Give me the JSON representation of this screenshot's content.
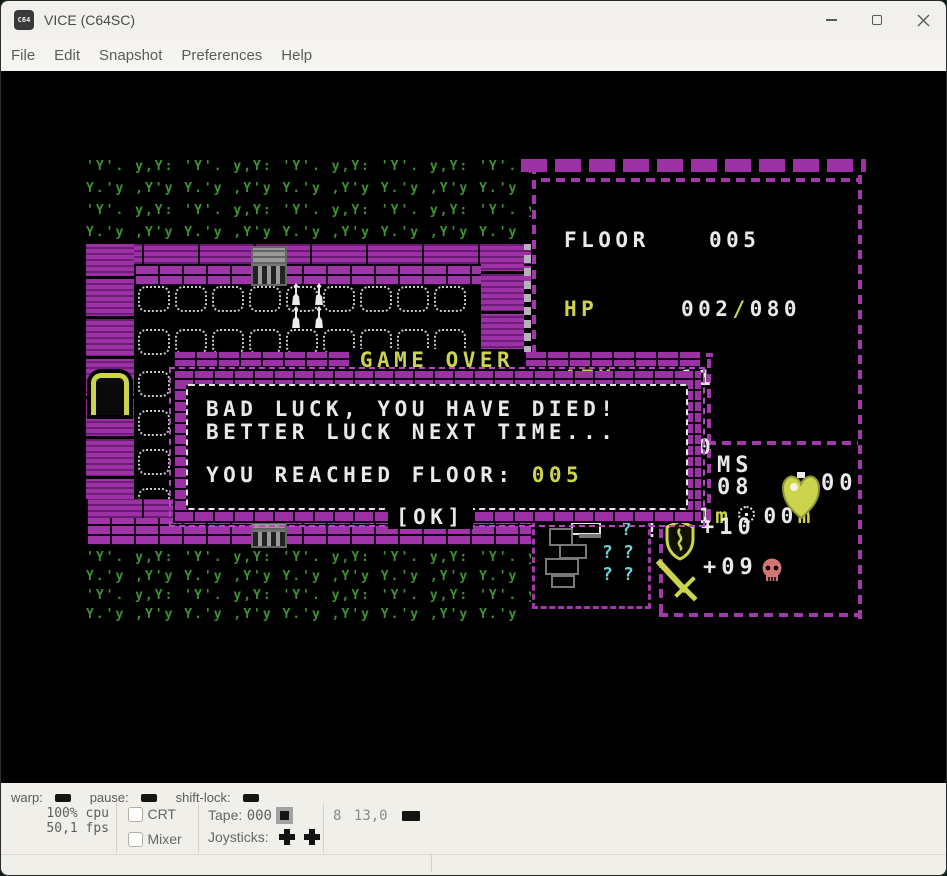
{
  "window": {
    "title": "VICE (C64SC)",
    "icon_text": "C64"
  },
  "menubar": {
    "items": [
      {
        "label": "File"
      },
      {
        "label": "Edit"
      },
      {
        "label": "Snapshot"
      },
      {
        "label": "Preferences"
      },
      {
        "label": "Help"
      }
    ]
  },
  "game": {
    "stats": {
      "floor_label": "FLOOR",
      "floor": "005",
      "hp_label": "HP",
      "hp_current": "002",
      "hp_sep": "/",
      "hp_max": "080",
      "atk_label": "ATK",
      "atk": "11",
      "def_label": "DEF",
      "def": "20",
      "range_label": "RANGE",
      "range_melee": "01",
      "range_melee_unit": "m",
      "range_ranged": "00",
      "range_ranged_unit": "m",
      "gold": "$0137"
    },
    "dialog": {
      "title": "GAME OVER",
      "line1": "BAD LUCK, YOU HAVE DIED!",
      "line2": "BETTER LUCK NEXT TIME...",
      "line3_label": "YOU REACHED FLOOR: ",
      "line3_value": "005",
      "ok_label": "[OK]"
    },
    "hud": {
      "ms_label": "MS",
      "ms_value": "08",
      "potion_count": "00",
      "shield_bonus": "+10",
      "sword_bonus": "+09"
    },
    "minimap": {
      "question_mark": "?",
      "alert_mark": "!"
    }
  },
  "statusbar": {
    "warp_label": "warp:",
    "pause_label": "pause:",
    "shiftlock_label": "shift-lock:",
    "cpu": "100% cpu",
    "fps": "50,1 fps",
    "crt_label": "CRT",
    "mixer_label": "Mixer",
    "tape_label": "Tape:",
    "tape_counter": "000",
    "joysticks_label": "Joysticks:",
    "drive_number": "8",
    "drive_track": "13,0"
  },
  "tiles": {
    "grass_row_a": "'Y'. y,Y: ",
    "grass_row_b": "Y.'y ,Y'y "
  },
  "colors": {
    "wall_purple": "#9c31a5",
    "hud_yellow": "#ccd44e",
    "grass_green": "#3f9233",
    "text_white": "#e9e9e9",
    "map_cyan": "#6fd2d2",
    "skull_red": "#cf7676",
    "chrome_bg": "#f2f0ed",
    "statusbar_bg": "#f1efea"
  }
}
